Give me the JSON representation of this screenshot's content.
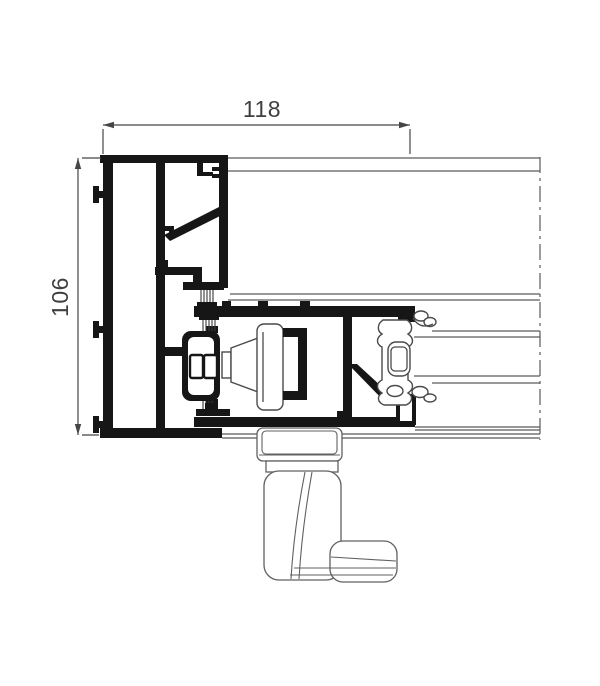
{
  "drawing": {
    "kind": "aluminium-profile-cross-section",
    "dimensions": {
      "width_label": "118",
      "height_label": "106"
    },
    "colors": {
      "profile_fill": "#161616",
      "thin_line": "#5a5a5a",
      "dimension_line": "#454545",
      "background": "#ffffff"
    }
  }
}
